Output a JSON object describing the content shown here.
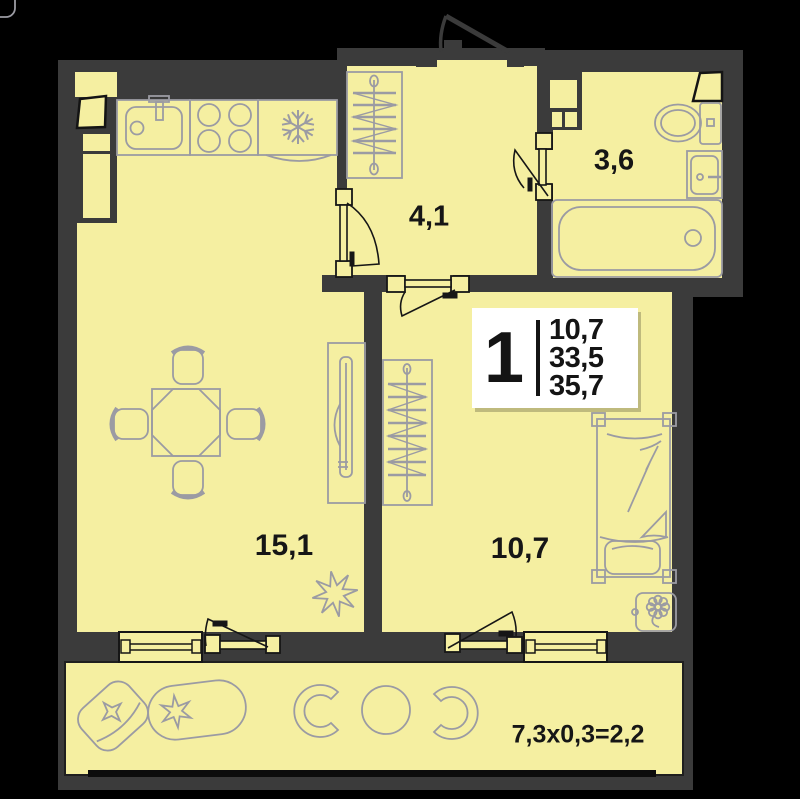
{
  "plan": {
    "type": "apartment-floor-plan",
    "rooms": [
      {
        "id": "hallway",
        "area_label": "4,1"
      },
      {
        "id": "bathroom",
        "area_label": "3,6"
      },
      {
        "id": "living-room",
        "area_label": "15,1"
      },
      {
        "id": "bedroom",
        "area_label": "10,7"
      },
      {
        "id": "balcony",
        "area_label": "7,3x0,3=2,2"
      }
    ],
    "stats": {
      "rooms_count": "1",
      "living_area": "10,7",
      "area_without_balcony": "33,5",
      "total_area": "35,7"
    },
    "colors": {
      "background": "#000000",
      "walls": "#3b3b3b",
      "room_fill": "#f5efa1",
      "furniture_stroke": "#9b9ba3",
      "frame_stroke": "#161616",
      "stats_bg": "#ffffff",
      "text": "#161616"
    },
    "icons": [
      "kitchen-sink-icon",
      "stove-icon",
      "fridge-snowflake-icon",
      "wardrobe-icon",
      "entrance-door-icon",
      "interior-door-icon",
      "toilet-icon",
      "washbasin-icon",
      "bathtub-icon",
      "riser-shaft-icon",
      "tv-stand-icon",
      "dining-table-icon",
      "chair-icon",
      "flower-icon",
      "bed-icon",
      "nightstand-plant-icon",
      "window-icon",
      "balcony-door-icon",
      "armchair-icon",
      "planter-icon",
      "balcony-chair-icon",
      "balcony-table-icon"
    ]
  }
}
